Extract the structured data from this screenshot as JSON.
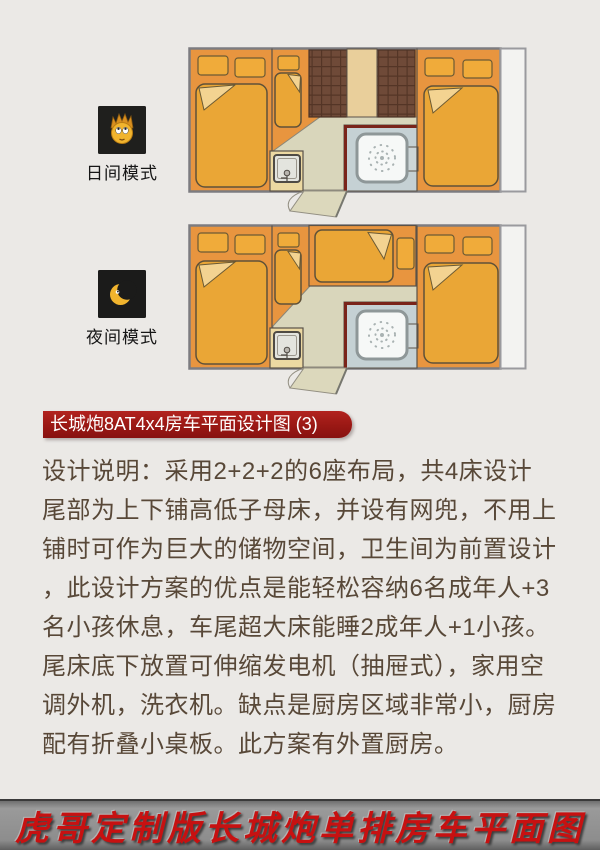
{
  "page": {
    "background_color": "#ebe9e6"
  },
  "modes": [
    {
      "label": "日间模式",
      "icon": "sun-face-icon"
    },
    {
      "label": "夜间模式",
      "icon": "crescent-moon-icon"
    }
  ],
  "title_banner": {
    "text": "长城炮8AT4x4房车平面设计图 (3)",
    "background_color": "#9a1814",
    "text_color": "#ffffff"
  },
  "description": {
    "text_color": "#584838",
    "lines": [
      "设计说明：采用2+2+2的6座布局，共4床设计",
      "尾部为上下铺高低子母床，并设有网兜，不用上",
      "铺时可作为巨大的储物空间，卫生间为前置设计",
      "，此设计方案的优点是能轻松容纳6名成年人+3",
      "名小孩休息，车尾超大床能睡2成年人+1小孩。",
      "尾床底下放置可伸缩发电机（抽屉式），家用空",
      "调外机，洗衣机。缺点是厨房区域非常小，厨房",
      "配有折叠小桌板。此方案有外置厨房。"
    ]
  },
  "footer_banner": {
    "text": "虎哥定制版长城炮单排房车平面图",
    "text_color": "#c71111",
    "background_color": "#8f8f8f"
  },
  "floorplan": {
    "colors": {
      "cabin_orange": "#e8953f",
      "mattress_gold": "#eaa636",
      "fold_highlight": "#f3d391",
      "floor_beige": "#d9d6bb",
      "tile_brown": "#6f4a38",
      "bathroom_blue": "#c5d1d4",
      "bathroom_border_maroon": "#7a241a",
      "shower_white": "#f6f8f7",
      "counter_tan": "#ecd9a2",
      "outline_gray": "#7c7c80",
      "rear_extension_white": "#f3f3f1"
    }
  }
}
